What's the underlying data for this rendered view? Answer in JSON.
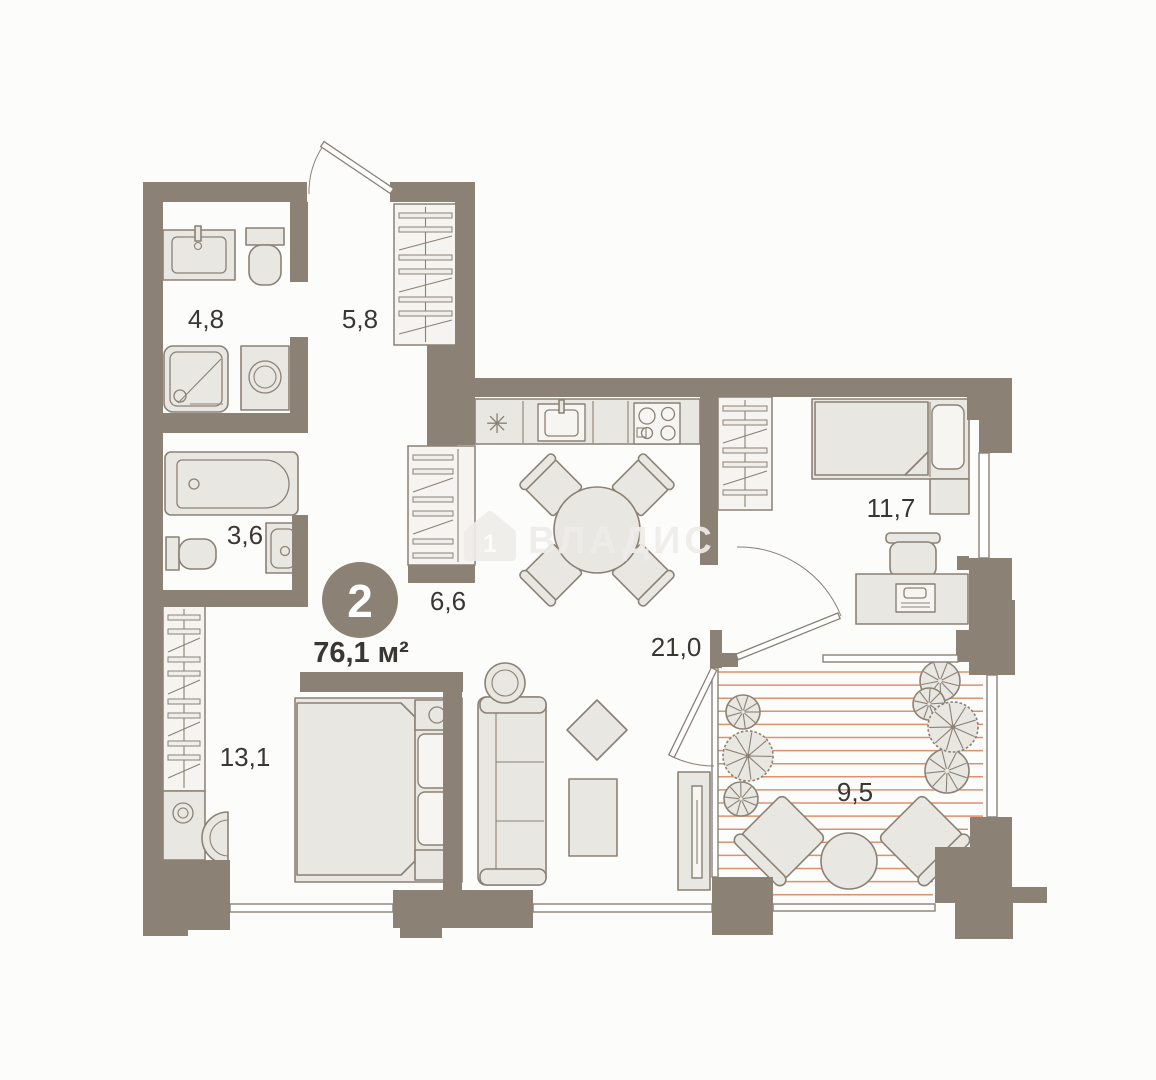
{
  "badge": {
    "room_count": "2",
    "total_area": "76,1 м²"
  },
  "watermark": {
    "brand": "ВЛАДИС",
    "icon": "house-icon",
    "icon_number": "1"
  },
  "kitchen": {
    "fridge_symbol": "✳"
  },
  "rooms": [
    {
      "id": "bathroom-small",
      "label": "4,8"
    },
    {
      "id": "entrance-hall",
      "label": "5,8"
    },
    {
      "id": "bathroom-bath",
      "label": "3,6"
    },
    {
      "id": "corridor",
      "label": "6,6"
    },
    {
      "id": "bedroom-main",
      "label": "13,1"
    },
    {
      "id": "kitchen-living",
      "label": "21,0"
    },
    {
      "id": "bedroom-second",
      "label": "11,7"
    },
    {
      "id": "terrace",
      "label": "9,5"
    }
  ],
  "colors": {
    "wall": "#8b8175",
    "furniture_fill": "#e9e7e2",
    "outline": "#8b8175",
    "terrace_hatch": "#e0906d",
    "label_text": "#3a3733",
    "badge_fill": "#8b8175",
    "badge_text": "#ffffff",
    "watermark": "#efede9"
  }
}
